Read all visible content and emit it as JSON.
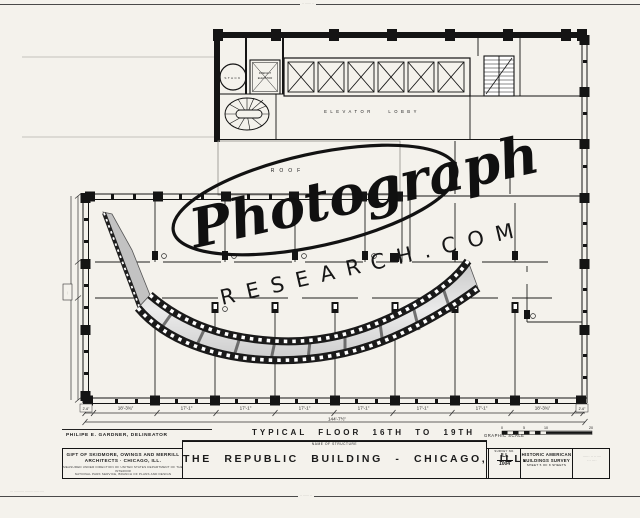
{
  "sheet": {
    "top_edge_text": "·· ······ ··",
    "bottom_left_text": "··· ·········· ········ ······   ····",
    "bottom_center_text": "·· ······ ··"
  },
  "plan": {
    "stack_label": "STACK",
    "freight_label_1": "FREIGHT",
    "freight_label_2": "ELEVATOR",
    "elevator_lobby_label": "ELEVATOR LOBBY",
    "roof_label": "ROOF",
    "dim_end_left": "2'-6\"",
    "dim_end_right": "2'-6\"",
    "dims": [
      "18'-3¾\"",
      "17'-1\"",
      "17'-1\"",
      "17'-1\"",
      "17'-1\"",
      "17'-1\"",
      "17'-1\"",
      "18'-3¾\""
    ],
    "overall_dim": "144'-7½\"",
    "left_dim_label": "···",
    "graphic_scale_label": "GRAPHIC SCALE",
    "scale_ticks": [
      "0",
      "5",
      "10",
      "20"
    ]
  },
  "watermark": {
    "script_text": "Photograph",
    "domain_text": "RESEARCH.COM"
  },
  "title_block": {
    "floor_title": "TYPICAL FLOOR 16TH TO 19TH",
    "delineator": "PHILIPE E. GARDNER, DELINEATOR",
    "credit_line1": "GIFT OF SKIDMORE, OWINGS AND MERRILL",
    "credit_line2": "ARCHITECTS  ·  CHICAGO, ILL.",
    "credit_line3": "MEASURED UNDER DIRECTION OF UNITED STATES DEPARTMENT OF THE INTERIOR",
    "credit_line4": "NATIONAL PARK SERVICE, BRANCH OF PLANS AND DESIGN",
    "name_header": "NAME OF STRUCTURE",
    "structure_name": "THE REPUBLIC BUILDING - CHICAGO, ILL.",
    "survey_header": "SURVEY NO.",
    "survey_state": "ILL",
    "survey_number": "1004",
    "habs_line1": "HISTORIC AMERICAN",
    "habs_line2": "BUILDINGS SURVEY",
    "habs_sheet": "SHEET 5 OF 8 SHEETS",
    "right_box_line1": "······ ·· ······",
    "right_box_line2": "··· ····"
  }
}
